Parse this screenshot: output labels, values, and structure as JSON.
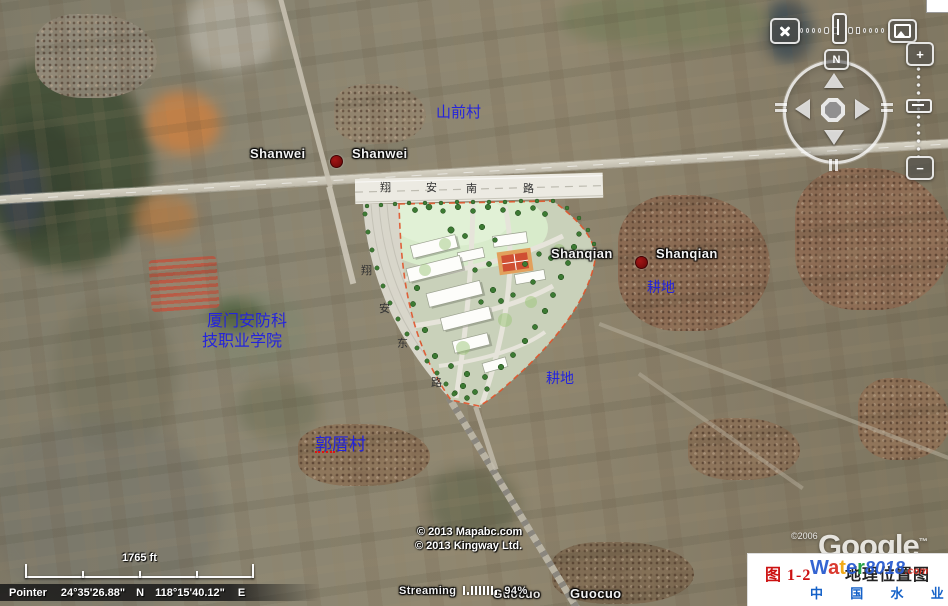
{
  "window": {
    "app": "Google Earth"
  },
  "labels": {
    "shanwei_left": "Shanwei",
    "shanwei_right": "Shanwei",
    "shanqian_left": "Shanqian",
    "shanqian_right": "Shanqian",
    "guocuo_left": "Guocuo",
    "guocuo_right": "Guocuo",
    "shanqian_village": "山前村",
    "guocuo_village": "郭厝村",
    "school_line1": "厦门安防科",
    "school_line2": "技职业学院",
    "farmland_east": "耕地",
    "farmland_south": "耕地"
  },
  "site_plan": {
    "south_road_chars": [
      "翔",
      "安",
      "南",
      "路"
    ],
    "east_road_chars": [
      "翔",
      "安",
      "东",
      "路"
    ]
  },
  "navigation": {
    "north_label": "N",
    "zoom_in_label": "+",
    "zoom_out_label": "−"
  },
  "status_bar": {
    "pointer_label": "Pointer",
    "latitude": "24°35'26.88\"",
    "lat_dir": "N",
    "longitude": "118°15'40.12\"",
    "lon_dir": "E",
    "streaming_label": "Streaming",
    "streaming_percent": "94%"
  },
  "scale_bar": {
    "distance_label": "1765 ft"
  },
  "attribution": {
    "copyright_line1": "© 2013 Mapabc.com",
    "copyright_line2": "© 2013 Kingway Ltd.",
    "imagery_copyright": "©2006",
    "logo_text": "Google",
    "logo_tm": "™"
  },
  "figure_caption": {
    "number": "图 1-2",
    "title": "地理位置图",
    "watermark_letters": [
      "W",
      "a",
      "t",
      "e",
      "r"
    ],
    "watermark_digits": "8018",
    "watermark_tld": ".com",
    "watermark_site_name": "中 国 水 业 网"
  },
  "colors": {
    "place_label_blue": "#2424dc",
    "place_dot_red": "#7c0e0e",
    "caption_red": "#cc1111",
    "caption_blue": "#1461c8",
    "site_boundary_red": "#e0532a"
  }
}
